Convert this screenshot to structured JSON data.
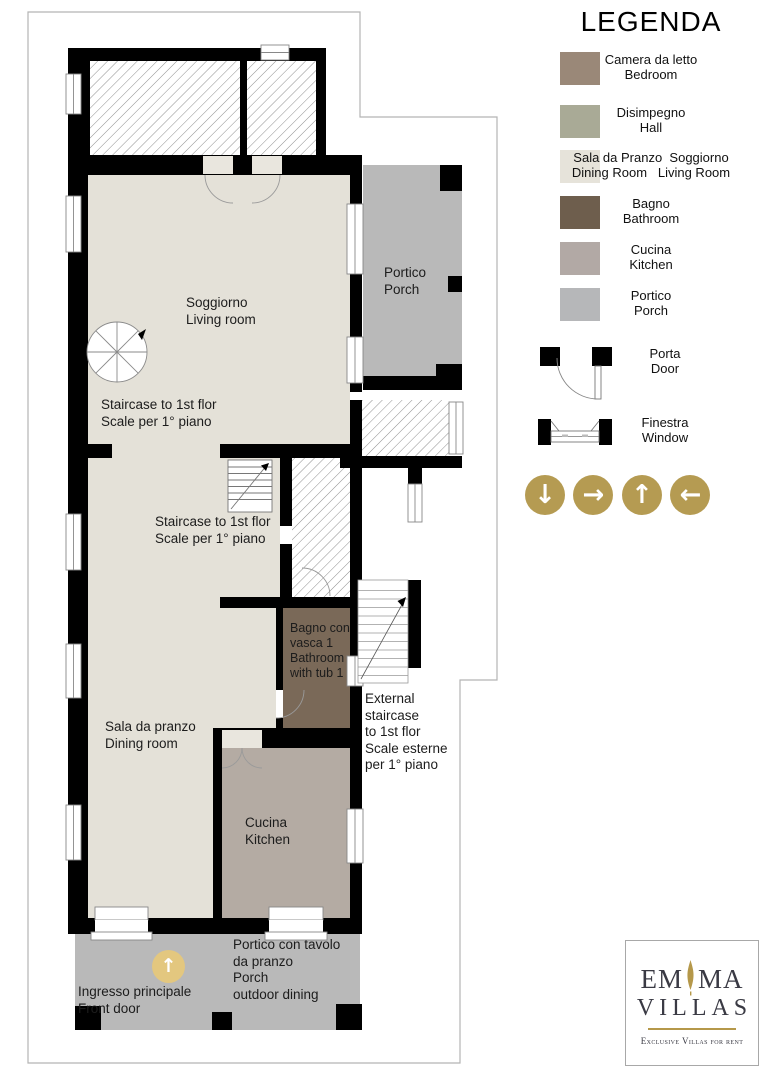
{
  "legend_title": "LEGENDA",
  "colors": {
    "wall": "#000000",
    "living": "#e4e1d8",
    "opening": "#e9e6de",
    "porch": "#b9b9b9",
    "kitchen": "#b4aba3",
    "bathroom": "#7a6958",
    "gold": "#b59b52",
    "gold_light": "#e3c77f",
    "logo_gold": "#b5984a"
  },
  "legend": {
    "items": [
      {
        "label_it": "Camera da letto",
        "label_en": "Bedroom",
        "color": "#9a8878"
      },
      {
        "label_it": "Disimpegno",
        "label_en": "Hall",
        "color": "#a9aa96"
      },
      {
        "label_it": "Sala da Pranzo  Soggiorno",
        "label_en": "Dining Room   Living Room",
        "color": "#e6e3da"
      },
      {
        "label_it": "Bagno",
        "label_en": "Bathroom",
        "color": "#6e5e4d"
      },
      {
        "label_it": "Cucina",
        "label_en": "Kitchen",
        "color": "#b2a9a5"
      },
      {
        "label_it": "Portico",
        "label_en": "Porch",
        "color": "#b6b7b9"
      }
    ],
    "door_label": "Porta\nDoor",
    "window_label": "Finestra\nWindow"
  },
  "nav": {
    "arrows": [
      {
        "name": "down",
        "glyph": "↓"
      },
      {
        "name": "right",
        "glyph": "→"
      },
      {
        "name": "up",
        "glyph": "↑"
      },
      {
        "name": "left",
        "glyph": "←"
      }
    ]
  },
  "plan": {
    "soggiorno": "Soggiorno\nLiving room",
    "stair_upper": "Staircase to 1st flor\nScale per 1° piano",
    "stair_mid": "Staircase to 1st flor\nScale per 1° piano",
    "portico_top": "Portico\nPorch",
    "bagno": "Bagno con\nvasca 1\nBathroom\nwith tub 1",
    "external_stair": "External\nstaircase\nto 1st flor\nScale esterne\nper 1° piano",
    "dining": "Sala da pranzo\nDining room",
    "cucina": "Cucina\nKitchen",
    "ingresso": "Ingresso principale\nFront door",
    "portico_bottom": "Portico con tavolo\nda pranzo\nPorch\noutdoor dining",
    "entry_arrow_glyph": "↑"
  },
  "logo": {
    "name_left": "EM",
    "name_right": "MA",
    "line2": "VILLAS",
    "tagline": "Exclusive Villas for rent"
  }
}
